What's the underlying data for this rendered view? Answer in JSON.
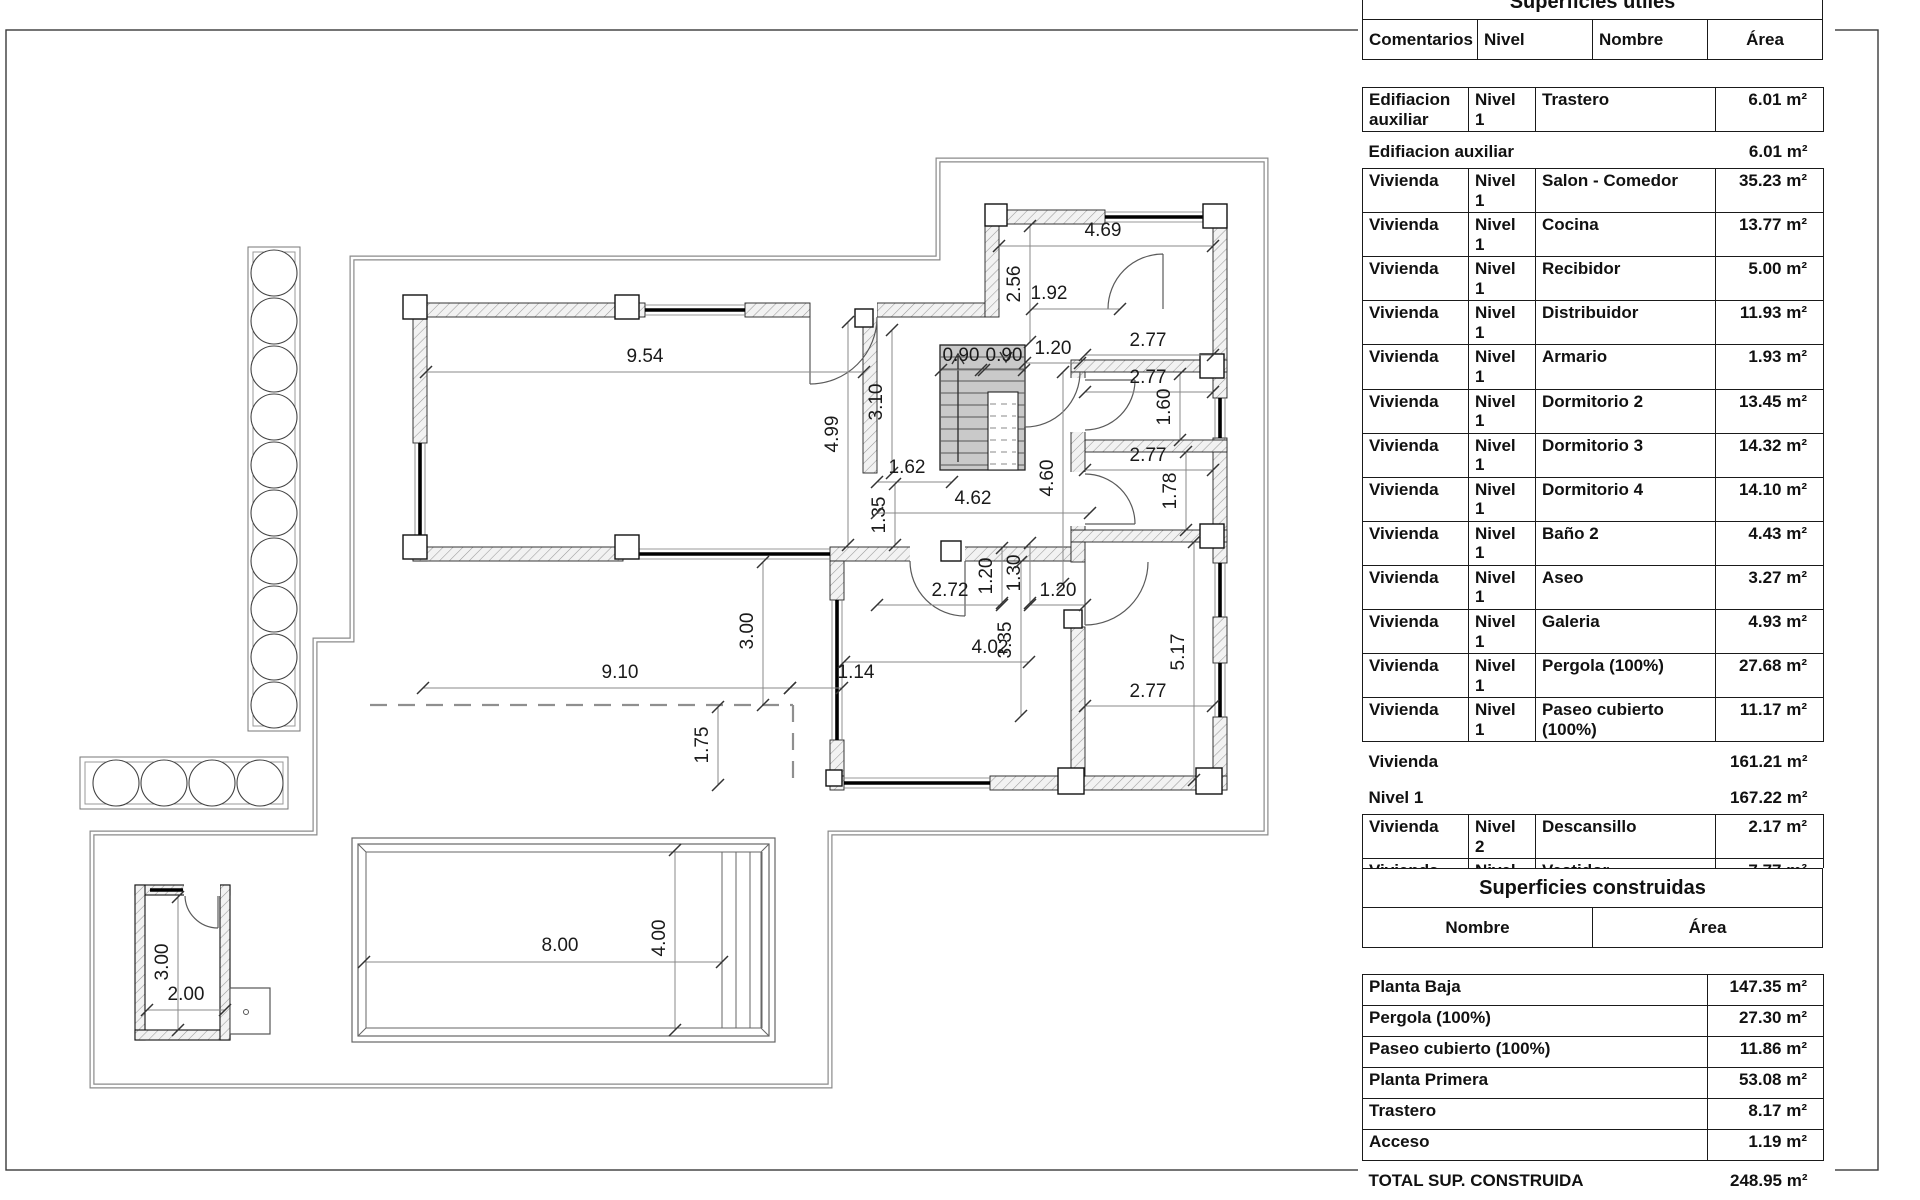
{
  "plan": {
    "dims": [
      {
        "t": "9.54",
        "x1": 426,
        "y1": 372,
        "x2": 864,
        "y2": 372,
        "lx": 645,
        "ly": 362,
        "v": false
      },
      {
        "t": "4.69",
        "x1": 999,
        "y1": 246,
        "x2": 1213,
        "y2": 246,
        "lx": 1103,
        "ly": 236,
        "v": false
      },
      {
        "t": "2.56",
        "x1": 1030,
        "y1": 226,
        "x2": 1030,
        "y2": 342,
        "lx": 1020,
        "ly": 284,
        "v": true
      },
      {
        "t": "1.92",
        "x1": 1032,
        "y1": 309,
        "x2": 1120,
        "y2": 309,
        "lx": 1049,
        "ly": 299,
        "v": false
      },
      {
        "t": "0.90",
        "x1": 941,
        "y1": 370,
        "x2": 981,
        "y2": 370,
        "lx": 961,
        "ly": 361,
        "v": false
      },
      {
        "t": "0.90",
        "x1": 984,
        "y1": 370,
        "x2": 1024,
        "y2": 370,
        "lx": 1004,
        "ly": 361,
        "v": false
      },
      {
        "t": "1.20",
        "x1": 1025,
        "y1": 363,
        "x2": 1080,
        "y2": 363,
        "lx": 1053,
        "ly": 354,
        "v": false
      },
      {
        "t": "3.10",
        "x1": 892,
        "y1": 330,
        "x2": 892,
        "y2": 473,
        "lx": 882,
        "ly": 402,
        "v": true
      },
      {
        "t": "4.99",
        "x1": 848,
        "y1": 322,
        "x2": 848,
        "y2": 545,
        "lx": 838,
        "ly": 434,
        "v": true
      },
      {
        "t": "1.62",
        "x1": 877,
        "y1": 482,
        "x2": 952,
        "y2": 482,
        "lx": 907,
        "ly": 473,
        "v": false
      },
      {
        "t": "1.35",
        "x1": 895,
        "y1": 484,
        "x2": 895,
        "y2": 545,
        "lx": 885,
        "ly": 515,
        "v": true
      },
      {
        "t": "4.62",
        "x1": 877,
        "y1": 513,
        "x2": 1090,
        "y2": 513,
        "lx": 973,
        "ly": 504,
        "v": false
      },
      {
        "t": "2.77",
        "x1": 1085,
        "y1": 355,
        "x2": 1213,
        "y2": 355,
        "lx": 1148,
        "ly": 346,
        "v": false
      },
      {
        "t": "2.77",
        "x1": 1085,
        "y1": 392,
        "x2": 1213,
        "y2": 392,
        "lx": 1148,
        "ly": 383,
        "v": false
      },
      {
        "t": "1.60",
        "x1": 1180,
        "y1": 374,
        "x2": 1180,
        "y2": 440,
        "lx": 1170,
        "ly": 407,
        "v": true
      },
      {
        "t": "2.77",
        "x1": 1085,
        "y1": 470,
        "x2": 1213,
        "y2": 470,
        "lx": 1148,
        "ly": 461,
        "v": false
      },
      {
        "t": "1.78",
        "x1": 1186,
        "y1": 452,
        "x2": 1186,
        "y2": 530,
        "lx": 1176,
        "ly": 491,
        "v": true
      },
      {
        "t": "4.60",
        "x1": 1063,
        "y1": 372,
        "x2": 1063,
        "y2": 584,
        "lx": 1053,
        "ly": 478,
        "v": true
      },
      {
        "t": "2.72",
        "x1": 877,
        "y1": 605,
        "x2": 1002,
        "y2": 605,
        "lx": 950,
        "ly": 596,
        "v": false
      },
      {
        "t": "1.20",
        "x1": 1002,
        "y1": 548,
        "x2": 1002,
        "y2": 603,
        "lx": 992,
        "ly": 576,
        "v": true
      },
      {
        "t": "1.30",
        "x1": 1030,
        "y1": 543,
        "x2": 1030,
        "y2": 603,
        "lx": 1020,
        "ly": 573,
        "v": true
      },
      {
        "t": "1.20",
        "x1": 1030,
        "y1": 605,
        "x2": 1085,
        "y2": 605,
        "lx": 1058,
        "ly": 596,
        "v": false
      },
      {
        "t": "4.02",
        "x1": 844,
        "y1": 662,
        "x2": 1029,
        "y2": 662,
        "lx": 990,
        "ly": 653,
        "v": false
      },
      {
        "t": "3.35",
        "x1": 1021,
        "y1": 562,
        "x2": 1021,
        "y2": 716,
        "lx": 1011,
        "ly": 640,
        "v": true
      },
      {
        "t": "5.17",
        "x1": 1194,
        "y1": 542,
        "x2": 1194,
        "y2": 780,
        "lx": 1184,
        "ly": 652,
        "v": true
      },
      {
        "t": "2.77",
        "x1": 1085,
        "y1": 706,
        "x2": 1213,
        "y2": 706,
        "lx": 1148,
        "ly": 697,
        "v": false
      },
      {
        "t": "3.00",
        "x1": 763,
        "y1": 562,
        "x2": 763,
        "y2": 705,
        "lx": 753,
        "ly": 631,
        "v": true
      },
      {
        "t": "9.10",
        "x1": 423,
        "y1": 688,
        "x2": 790,
        "y2": 688,
        "lx": 620,
        "ly": 678,
        "v": false
      },
      {
        "t": "1.14",
        "x1": 790,
        "y1": 688,
        "x2": 842,
        "y2": 688,
        "lx": 856,
        "ly": 678,
        "v": false
      },
      {
        "t": "1.75",
        "x1": 718,
        "y1": 707,
        "x2": 718,
        "y2": 785,
        "lx": 708,
        "ly": 745,
        "v": true
      },
      {
        "t": "8.00",
        "x1": 364,
        "y1": 962,
        "x2": 722,
        "y2": 962,
        "lx": 560,
        "ly": 951,
        "v": false
      },
      {
        "t": "4.00",
        "x1": 675,
        "y1": 850,
        "x2": 675,
        "y2": 1030,
        "lx": 665,
        "ly": 938,
        "v": true
      },
      {
        "t": "3.00",
        "x1": 178,
        "y1": 897,
        "x2": 178,
        "y2": 1030,
        "lx": 168,
        "ly": 962,
        "v": true
      },
      {
        "t": "2.00",
        "x1": 147,
        "y1": 1010,
        "x2": 225,
        "y2": 1010,
        "lx": 186,
        "ly": 1000,
        "v": false
      }
    ]
  },
  "tables": {
    "util": {
      "title": "Superficies utiles",
      "headers": [
        "Comentarios",
        "Nivel",
        "Nombre",
        "Área"
      ],
      "rows": [
        {
          "type": "detail",
          "comentarios": "Edifiacion auxiliar",
          "nivel": "Nivel 1",
          "nombre": "Trastero",
          "area": "6.01 m²"
        },
        {
          "type": "summary",
          "label": "Edifiacion auxiliar",
          "area": "6.01 m²"
        },
        {
          "type": "detail",
          "comentarios": "Vivienda",
          "nivel": "Nivel 1",
          "nombre": "Salon - Comedor",
          "area": "35.23 m²"
        },
        {
          "type": "detail",
          "comentarios": "Vivienda",
          "nivel": "Nivel 1",
          "nombre": "Cocina",
          "area": "13.77 m²"
        },
        {
          "type": "detail",
          "comentarios": "Vivienda",
          "nivel": "Nivel 1",
          "nombre": "Recibidor",
          "area": "5.00 m²"
        },
        {
          "type": "detail",
          "comentarios": "Vivienda",
          "nivel": "Nivel 1",
          "nombre": "Distribuidor",
          "area": "11.93 m²"
        },
        {
          "type": "detail",
          "comentarios": "Vivienda",
          "nivel": "Nivel 1",
          "nombre": "Armario",
          "area": "1.93 m²"
        },
        {
          "type": "detail",
          "comentarios": "Vivienda",
          "nivel": "Nivel 1",
          "nombre": "Dormitorio 2",
          "area": "13.45 m²"
        },
        {
          "type": "detail",
          "comentarios": "Vivienda",
          "nivel": "Nivel 1",
          "nombre": "Dormitorio 3",
          "area": "14.32 m²"
        },
        {
          "type": "detail",
          "comentarios": "Vivienda",
          "nivel": "Nivel 1",
          "nombre": "Dormitorio 4",
          "area": "14.10 m²"
        },
        {
          "type": "detail",
          "comentarios": "Vivienda",
          "nivel": "Nivel 1",
          "nombre": "Baño 2",
          "area": "4.43 m²"
        },
        {
          "type": "detail",
          "comentarios": "Vivienda",
          "nivel": "Nivel 1",
          "nombre": "Aseo",
          "area": "3.27 m²"
        },
        {
          "type": "detail",
          "comentarios": "Vivienda",
          "nivel": "Nivel 1",
          "nombre": "Galeria",
          "area": "4.93 m²"
        },
        {
          "type": "detail",
          "comentarios": "Vivienda",
          "nivel": "Nivel 1",
          "nombre": "Pergola (100%)",
          "area": "27.68 m²"
        },
        {
          "type": "detail",
          "comentarios": "Vivienda",
          "nivel": "Nivel 1",
          "nombre": "Paseo cubierto (100%)",
          "area": "11.17 m²"
        },
        {
          "type": "summary",
          "label": "Vivienda",
          "area": "161.21 m²"
        },
        {
          "type": "summary",
          "label": "Nivel 1",
          "area": "167.22 m²"
        },
        {
          "type": "detail",
          "comentarios": "Vivienda",
          "nivel": "Nivel 2",
          "nombre": "Descansillo",
          "area": "2.17 m²"
        },
        {
          "type": "detail",
          "comentarios": "Vivienda",
          "nivel": "Nivel 2",
          "nombre": "Vestidor",
          "area": "7.77 m²"
        },
        {
          "type": "detail",
          "comentarios": "Vivienda",
          "nivel": "Nivel 2",
          "nombre": "Baño 1",
          "area": "7.93 m²"
        },
        {
          "type": "detail",
          "comentarios": "Vivienda",
          "nivel": "Nivel 2",
          "nombre": "Dormitorio 1",
          "area": "20.21 m²"
        },
        {
          "type": "detail",
          "comentarios": "Vivienda",
          "nivel": "Nivel 2",
          "nombre": "Escalera",
          "area": "5.15 m²"
        },
        {
          "type": "summary",
          "label": "Vivienda",
          "area": "43.23 m²"
        },
        {
          "type": "summary",
          "label": "Nivel 2",
          "area": "43.23 m²"
        },
        {
          "type": "summary",
          "label": "TOTAL SUPERFICIE UTIL",
          "area": "210.45 m²"
        }
      ]
    },
    "construida": {
      "title": "Superficies construidas",
      "headers": [
        "Nombre",
        "Área"
      ],
      "rows": [
        {
          "type": "detail",
          "nombre": "Planta Baja",
          "area": "147.35 m²"
        },
        {
          "type": "detail",
          "nombre": "Pergola (100%)",
          "area": "27.30 m²"
        },
        {
          "type": "detail",
          "nombre": "Paseo cubierto (100%)",
          "area": "11.86 m²"
        },
        {
          "type": "detail",
          "nombre": "Planta Primera",
          "area": "53.08 m²"
        },
        {
          "type": "detail",
          "nombre": "Trastero",
          "area": "8.17 m²"
        },
        {
          "type": "detail",
          "nombre": "Acceso",
          "area": "1.19 m²"
        },
        {
          "type": "summary",
          "label": "TOTAL SUP. CONSTRUIDA",
          "area": "248.95 m²"
        }
      ]
    }
  }
}
